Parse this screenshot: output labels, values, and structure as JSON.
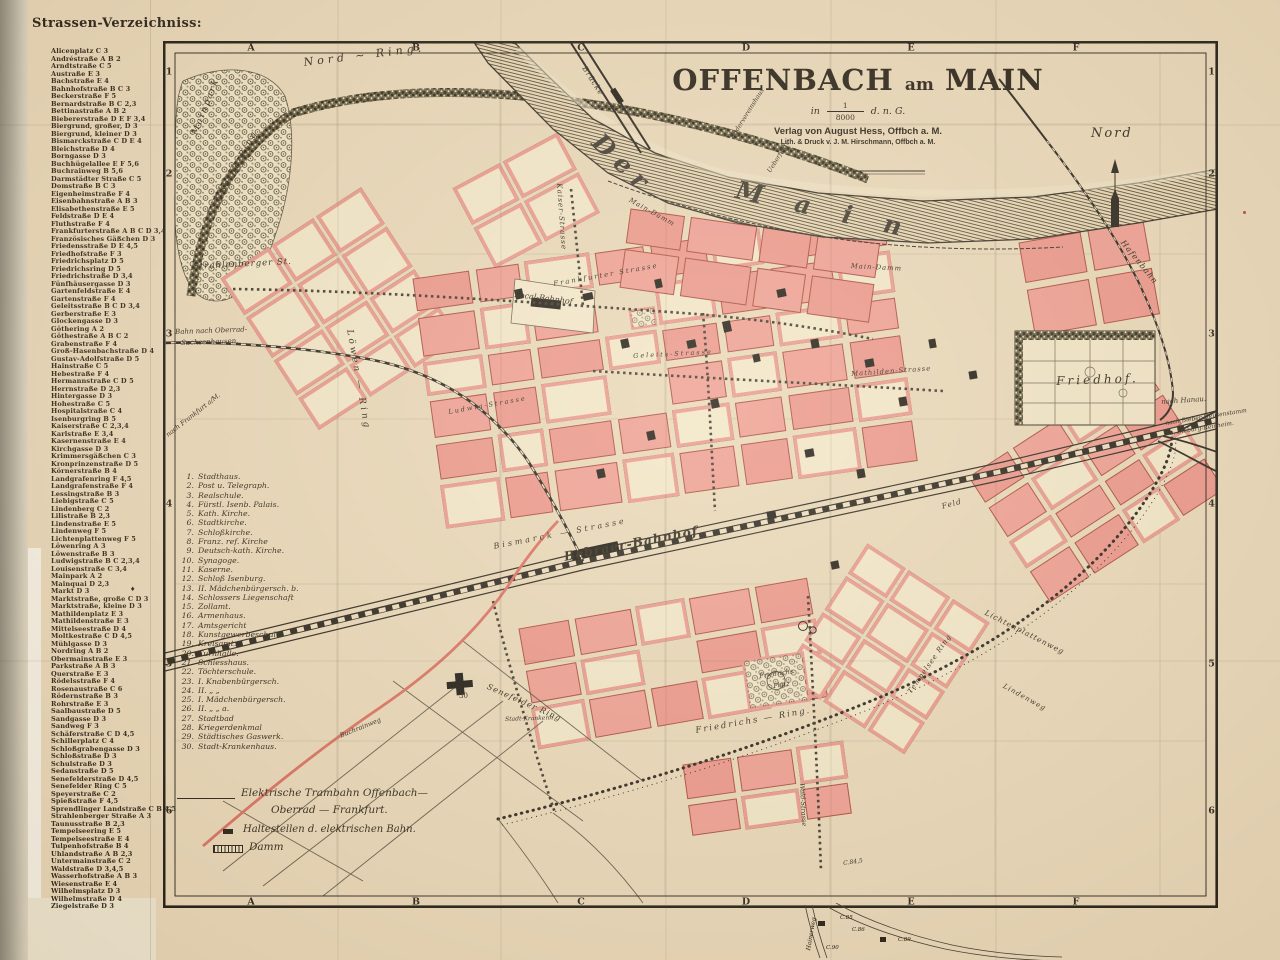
{
  "page": {
    "heading": "Strassen-Verzeichniss:",
    "index_marker": "♦"
  },
  "street_index": [
    "Alicenplatz C 3",
    "Andréstraße A B 2",
    "Arndtstraße C 5",
    "Austraße E 3",
    "Bachstraße E 4",
    "Bahnhofstraße B C 3",
    "Beckerstraße F 5",
    "Bernardstraße B C 2,3",
    "Bettinastraße A B 2",
    "Biebererstraße D E F 3,4",
    "Biergrund, großer, D 3",
    "Biergrund, kleiner D 3",
    "Bismarckstraße C D E 4",
    "Bleichstraße D 4",
    "Borngasse D 3",
    "Buchhügelallee E F 5,6",
    "Buchrainweg B 5,6",
    "Darmstädter Straße C 5",
    "Domstraße B C 3",
    "Eigenheimstraße F 4",
    "Eisenbahnstraße A B 3",
    "Elisabethenstraße E 5",
    "Feldstraße D E 4",
    "Fluthstraße F 4",
    "Frankfurterstraße A B C D 3,4",
    "Französisches Gäßchen D 3",
    "Friedensstraße D E 4,5",
    "Friedhofstraße F 3",
    "Friedrichsplatz D 5",
    "Friedrichsring D 5",
    "Friedrichstraße D 3,4",
    "Fünfhäusergasse D 3",
    "Gartenfeldstraße E 4",
    "Gartenstraße F 4",
    "Geleitsstraße B C D 3,4",
    "Gerberstraße E 3",
    "Glockengasse D 3",
    "Göthering A 2",
    "Göthestraße A B C 2",
    "Grabenstraße F 4",
    "Groß-Hasenbachstraße D 4",
    "Gustav-Adolfstraße D 5",
    "Hainstraße C 5",
    "Hebestraße F 4",
    "Hermannstraße C D 5",
    "Herrnstraße D 2,3",
    "Hintergasse D 3",
    "Hohestraße C 5",
    "Hospitalstraße C 4",
    "Isenburgring B 5",
    "Kaiserstraße C 2,3,4",
    "Karlstraße E 3,4",
    "Kasernenstraße E 4",
    "Kirchgasse D 3",
    "Krimmersgäßchen C 3",
    "Kronprinzenstraße D 5",
    "Körnerstraße B 4",
    "Landgrafenring F 4,5",
    "Landgrafenstraße F 4",
    "Lessingstraße B 3",
    "Liebigstraße C 5",
    "Lindenberg C 2",
    "Lilistraße B 2,3",
    "Lindenstraße E 5",
    "Lindenweg F 5",
    "Lichtenplattenweg F 5",
    "Löwenring A 3",
    "Löwenstraße B 3",
    "Ludwigstraße B C 2,3,4",
    "Louisenstraße C 3,4",
    "Mainpark A 2",
    "Mainquai D 2,3",
    "Markt D 3",
    "Marktstraße, große C D 3",
    "Marktstraße, kleine D 3",
    "Mathildenplatz E 3",
    "Mathildenstraße E 3",
    "Mittelseestraße D 4",
    "Moltkestraße C D 4,5",
    "Mühlgasse D 3",
    "Nordring A B 2",
    "Obermainstraße E 3",
    "Parkstraße A B 3",
    "Querstraße E 3",
    "Rödelsstraße F 4",
    "Rosenaustraße C 6",
    "Rödernstraße B 3",
    "Rohrstraße E 3",
    "Saalbaustraße D 5",
    "Sandgasse D 3",
    "Sandweg F 3",
    "Schäferstraße C D 4,5",
    "Schillerplatz C 4",
    "Schloßgrabengasse D 3",
    "Schloßstraße D 3",
    "Schulstraße D 3",
    "Sedanstraße D 5",
    "Senefelderstraße D 4,5",
    "Senefelder Ring C 5",
    "Speyerstraße C 2",
    "Spießstraße F 4,5",
    "Sprendlinger Landstraße C B 4,5",
    "Strahlenberger Straße A 3",
    "Taunusstraße B 2,3",
    "Tempelseering E 5",
    "Tempelseestraße E 4",
    "Tulpenhofstraße B 4",
    "Uhlandstraße A B 2,3",
    "Untermainstraße C 2",
    "Waldstraße D 3,4,5",
    "Wasserhofstraße A B 3",
    "Wiesenstraße E 4",
    "Wilhelmsplatz D 3",
    "Wilhelmstraße D 4",
    "Ziegelstraße D 3"
  ],
  "map": {
    "title_parts": {
      "left": "OFFENBACH",
      "am": "am",
      "right": "MAIN"
    },
    "scale": {
      "prefix": "in",
      "numerator": "1",
      "denominator": "8000",
      "suffix": "d. n. G."
    },
    "publisher": "Verlag von August Hess, Offbch a. M.",
    "printer": "Lith. & Druck v. J. M. Hirschmann, Offbch a. M.",
    "compass": "Nord",
    "grid_cols": [
      "A",
      "B",
      "C",
      "D",
      "E",
      "F"
    ],
    "grid_rows": [
      "1",
      "2",
      "3",
      "4",
      "5",
      "6"
    ],
    "legend_numbered": [
      "Stadthaus.",
      "Post u. Telegraph.",
      "Realschule.",
      "Fürstl. Isenb. Palais.",
      "Kath. Kirche.",
      "Stadtkirche.",
      "Schloßkirche.",
      "Franz. ref. Kirche",
      "Deutsch-kath. Kirche.",
      "Synagoge.",
      "Kaserne.",
      "Schloß Isenburg.",
      "II. Mädchenbürgersch. b.",
      "Schlossers Liegenschaft",
      "Zollamt.",
      "Armenhaus.",
      "Amtsgericht",
      "Kunstgewerbeschule.",
      "Kreisamt.",
      "Turnhalle.",
      "Schiesshaus.",
      "Töchterschule.",
      "I. Knabenbürgersch.",
      "II.  „  „",
      "I. Mädchenbürgersch.",
      "II.  „  „  a.",
      "Stadtbad",
      "Kriegerdenkmal",
      "Städtisches Gaswerk.",
      "Stadt-Krankenhaus."
    ],
    "legend_symbols": {
      "tram1": "Elektrische Trambahn Offenbach—",
      "tram2": "Oberrad — Frankfurt.",
      "stops": "Haltestellen d. elektrischen Bahn.",
      "damm": "Damm"
    },
    "street_labels": {
      "nord_ring": "Nord ~ Ring.",
      "mainpark": "Mainpark",
      "goethe_ring": "Goethe-Ring",
      "strahlenberger": "Strahlenberger St.",
      "bahn_oberrad1": "Bahn nach Oberrad-",
      "bahn_oberrad2": "Sachsenhausen.",
      "nach_frankfurt": "nach Frankfurt a/M.",
      "loewen_ring": "Löwen — Ring",
      "bruecke": "Brücke",
      "der": "Der",
      "main": "M a i n",
      "rudervereinshaus": "Rudervereinshaus",
      "ueberfahrt": "Ueberfahrt",
      "main_damm": "Main-Damm",
      "main_damm2": "Main-Damm",
      "hafenbahn": "Hafenbahn",
      "local_bahnhof": "Local-Bahnhof",
      "frankfurter": "Frankfurter Strasse",
      "kaiser": "Kaiser-Strasse",
      "geleits": "Geleits-Strasse",
      "ludwig": "Ludwig-Strasse",
      "mathilden": "Mathilden-Strasse",
      "friedhof": "Friedhof.",
      "nach_hanau": "nach Hanau.",
      "nach_bieber": "nach Bieber-Heusenstamm",
      "nach_dieburg": "u. Dieburg-Reinheim.",
      "bismarck": "Bismarck — Strasse",
      "bebraer": "Bebraer-Bahnhof",
      "feld": "Feld",
      "senefelder": "Senefelder Ring",
      "friedrichs_ring": "Friedrichs — Ring.",
      "friedrichs_platz1": "Friedrichs",
      "friedrichs_platz2": "Platz",
      "krankenhaus": "Stadt-Krankenh.",
      "kh_nr": "30",
      "buchrainweg": "Buchrainweg",
      "wald": "Wald-Strasse",
      "tempelsee": "Tempelsee Ring",
      "lichtenplatten": "Lichtenplattenweg",
      "lindenweg": "Lindenweg",
      "c845": "C.84,5"
    },
    "margin_labels": {
      "hainerweg": "Hainerweg",
      "c85": "C.85",
      "c86": "C.86",
      "c89": "C.89",
      "c90": "C.90"
    }
  }
}
